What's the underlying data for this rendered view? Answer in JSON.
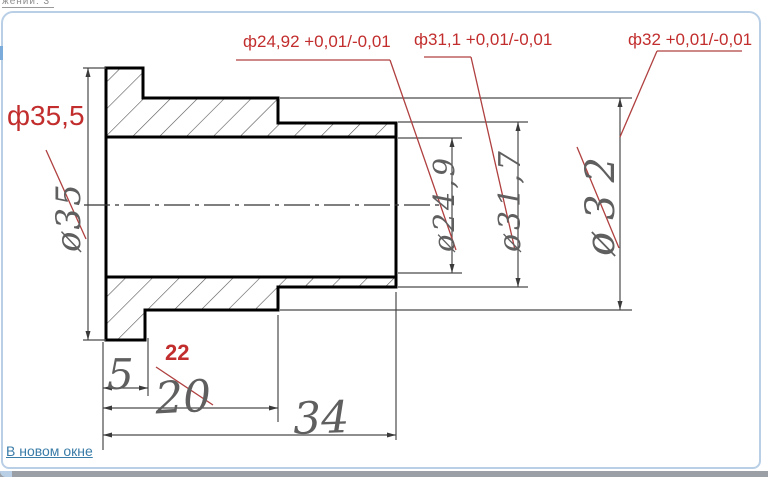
{
  "window": {
    "top_cropped_label": "жений: 3",
    "new_window_link": "В новом окне"
  },
  "colors": {
    "annotation_red": "#c22d2d",
    "red_line": "#b04040",
    "link_blue": "#3a7ca8",
    "handwritten_gray": "#5f5f5f",
    "frame_blue": "#b9cfe6"
  },
  "red_annotations": {
    "bore_dia": "ф24,92 +0,01/-0,01",
    "step_dia": "ф31,1 +0,01/-0,01",
    "outer_dia": "ф32 +0,01/-0,01",
    "flange_dia": "ф35,5",
    "step_length": "22"
  },
  "handwritten_dims": {
    "flange_dia": "ø35",
    "bore_dia": "ø24,9",
    "step_dia": "ø31,7",
    "outer_dia": "ø32",
    "flange_length": "5",
    "step_length": "20",
    "total_length": "34"
  }
}
